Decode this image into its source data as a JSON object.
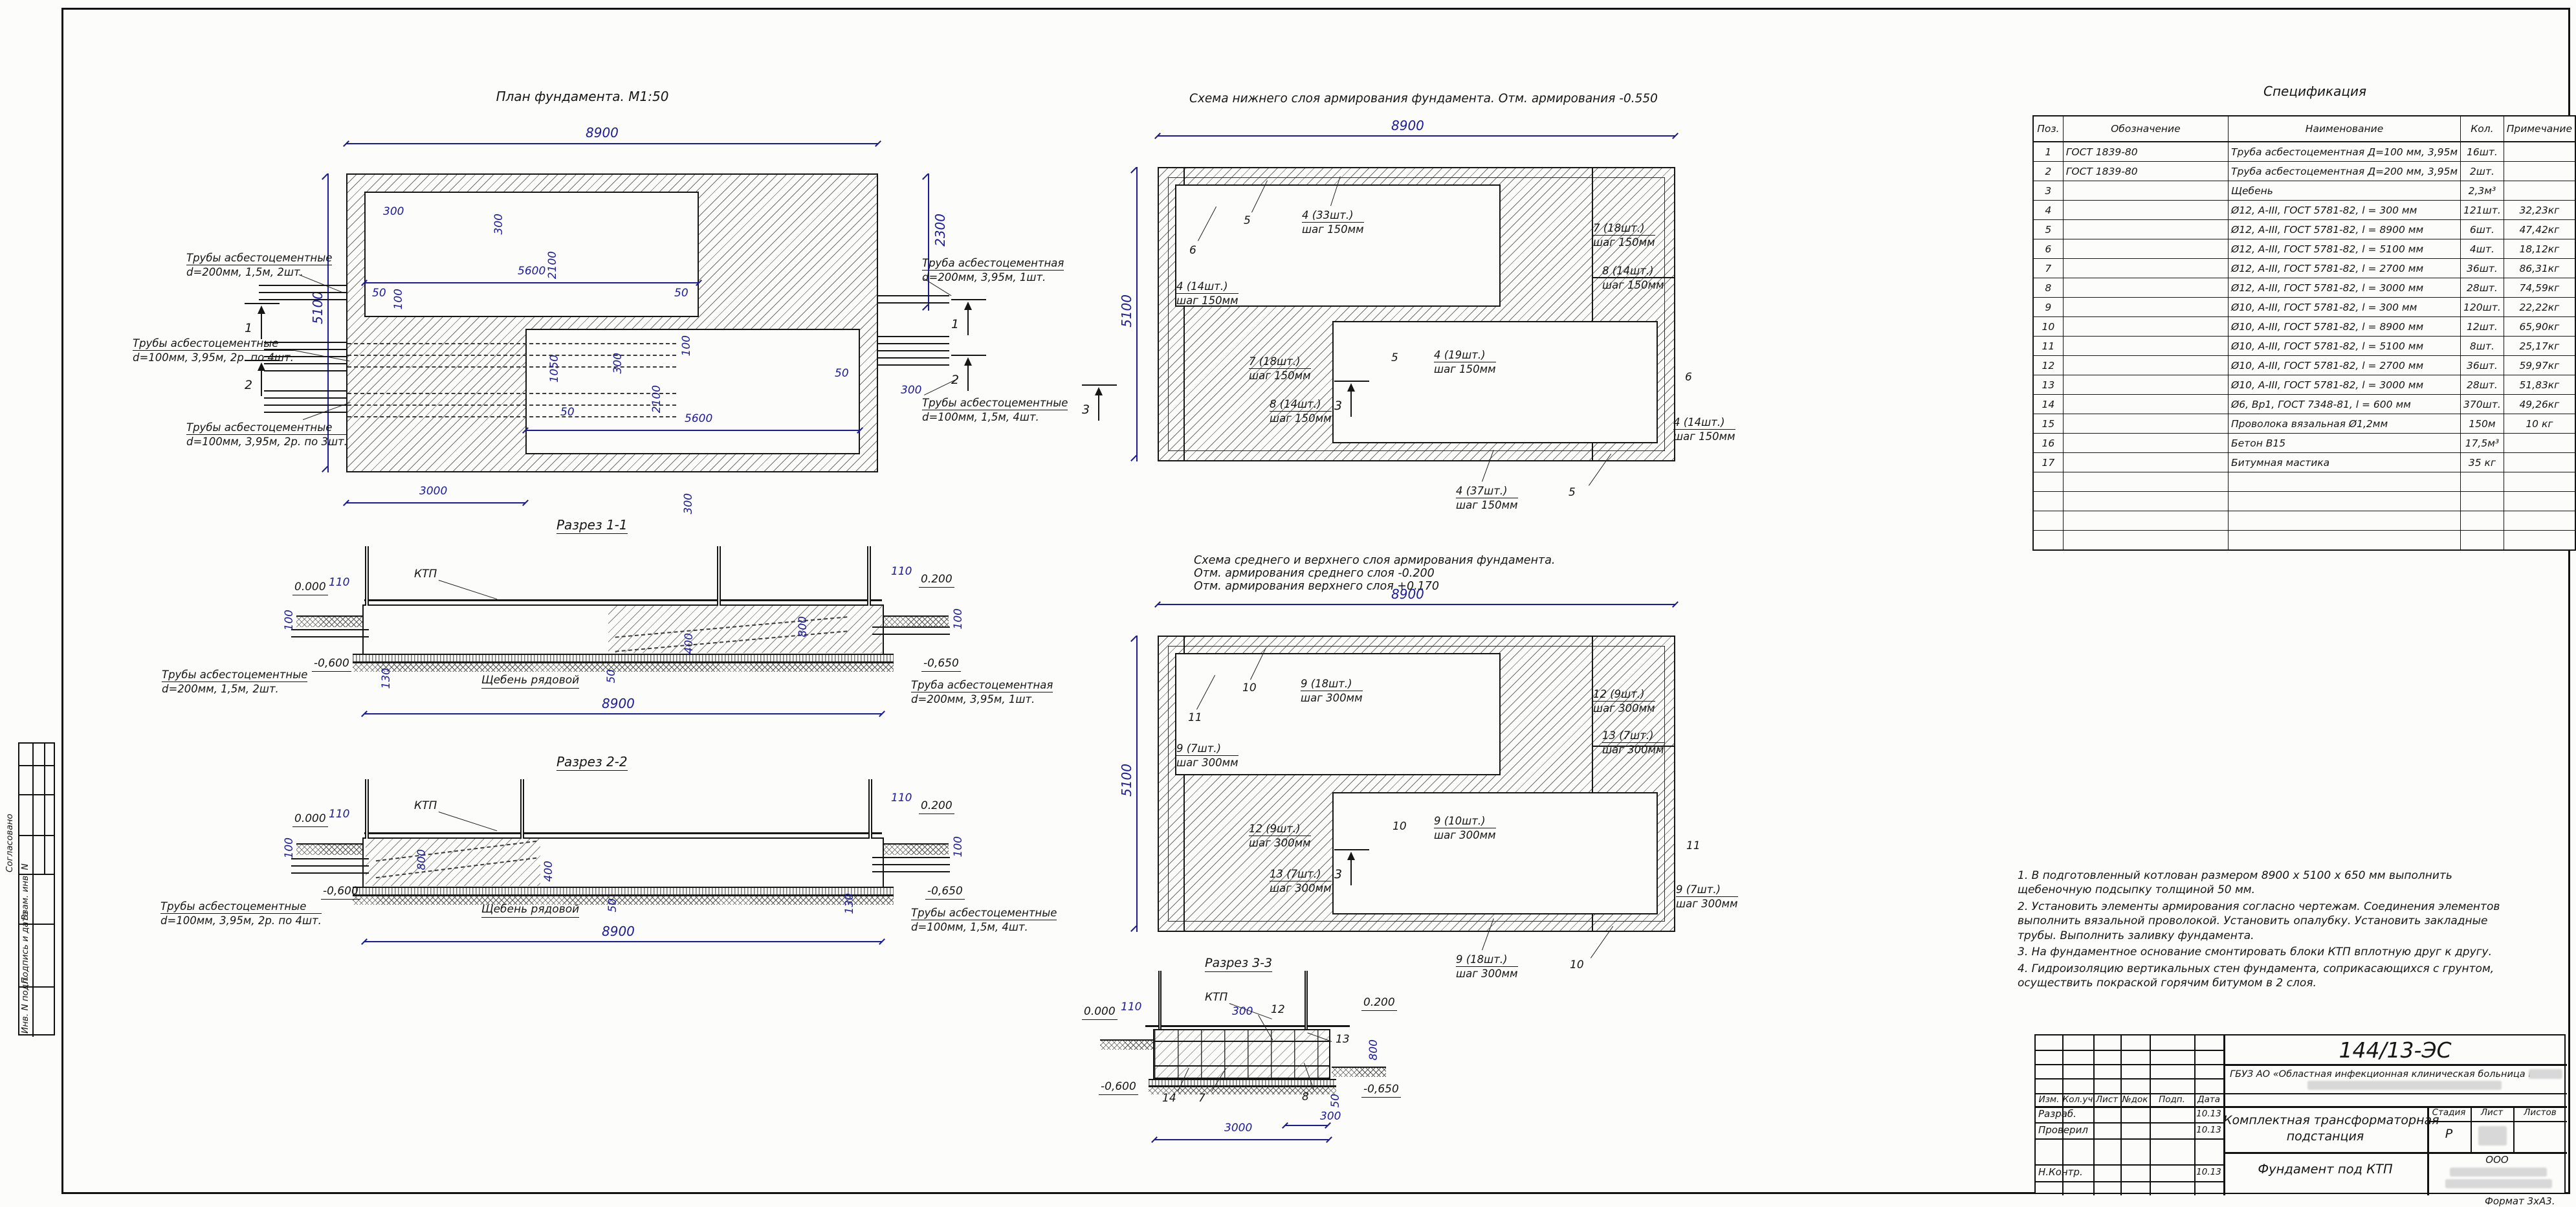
{
  "marks": {
    "m1": "1",
    "m2": "2",
    "m3": "3"
  },
  "side_stamp": {
    "soglasovano": "Согласовано",
    "vzam": "Взам. инв. N",
    "podpis": "Подпись и дата",
    "inv": "Инв. N подл."
  },
  "format_note": "Формат 3xА3.",
  "plan": {
    "title": "План фундамента. М1:50",
    "dims": {
      "d8900": "8900",
      "d5100": "5100",
      "d2300": "2300",
      "d300": "300",
      "d2100": "2100",
      "d5600": "5600",
      "d50": "50",
      "d100": "100",
      "d1050": "1050",
      "d3000": "3000"
    },
    "pipes": {
      "left_top": [
        "Трубы асбестоцементные",
        "d=200мм, 1,5м, 2шт."
      ],
      "left_mid": [
        "Трубы асбестоцементные",
        "d=100мм, 3,95м, 2р. по 4шт."
      ],
      "left_bot": [
        "Трубы асбестоцементные",
        "d=100мм, 3,95м, 2р. по 3шт."
      ],
      "right_top": [
        "Труба асбестоцементная",
        "d=200мм, 3,95м, 1шт."
      ],
      "right_bot": [
        "Трубы асбестоцементные",
        "d=100мм, 1,5м, 4шт."
      ]
    }
  },
  "scheme1": {
    "title": "Схема нижнего слоя армирования фундамента. Отм. армирования -0.550",
    "dims": {
      "d8900": "8900",
      "d5100": "5100"
    },
    "callouts": {
      "c5": "5",
      "c6": "6",
      "a33": [
        "4 (33шт.)",
        "шаг 150мм"
      ],
      "a14": [
        "4 (14шт.)",
        "шаг 150мм"
      ],
      "a19": [
        "4 (19шт.)",
        "шаг 150мм"
      ],
      "a37": [
        "4 (37шт.)",
        "шаг 150мм"
      ],
      "b18": [
        "7 (18шт.)",
        "шаг 150мм"
      ],
      "b14": [
        "8 (14шт.)",
        "шаг 150мм"
      ]
    }
  },
  "scheme2": {
    "title_line1": "Схема среднего и верхнего слоя армирования фундамента.",
    "title_line2": "Отм. армирования среднего слоя -0.200",
    "title_line3": "Отм. армирования верхнего слоя +0.170",
    "dims": {
      "d8900": "8900",
      "d5100": "5100"
    },
    "callouts": {
      "c10": "10",
      "c11": "11",
      "n18": [
        "9 (18шт.)",
        "шаг 300мм"
      ],
      "n7": [
        "9 (7шт.)",
        "шаг 300мм"
      ],
      "n10": [
        "9 (10шт.)",
        "шаг 300мм"
      ],
      "m9": [
        "12 (9шт.)",
        "шаг 300мм"
      ],
      "m7": [
        "13 (7шт.)",
        "шаг 300мм"
      ]
    }
  },
  "sections": {
    "s1_title": "Разрез 1-1",
    "s2_title": "Разрез 2-2",
    "s3_title": "Разрез 3-3",
    "ktp": "КТП",
    "gravel": "Щебень рядовой",
    "levels": {
      "zero": "0.000",
      "plus200": "0.200",
      "minus600": "-0,600",
      "minus650": "-0,650"
    },
    "dims": {
      "d110": "110",
      "d100": "100",
      "d800": "800",
      "d400": "400",
      "d50": "50",
      "d130": "130",
      "d8900": "8900",
      "d300": "300",
      "d3000": "3000"
    },
    "bars": {
      "r7": "7",
      "r8": "8",
      "r12": "12",
      "r13": "13",
      "r14": "14"
    },
    "s1_pipe_left": [
      "Трубы асбестоцементные",
      "d=200мм, 1,5м, 2шт."
    ],
    "s1_pipe_right": [
      "Труба асбестоцементная",
      "d=200мм, 3,95м, 1шт."
    ],
    "s2_pipe_left": [
      "Трубы асбестоцементные",
      "d=100мм, 3,95м, 2р. по 4шт."
    ],
    "s2_pipe_right": [
      "Трубы асбестоцементные",
      "d=100мм, 1,5м, 4шт."
    ]
  },
  "specification": {
    "title": "Спецификация",
    "headers": [
      "Поз.",
      "Обозначение",
      "Наименование",
      "Кол.",
      "Примечание"
    ],
    "rows": [
      [
        "1",
        "ГОСТ 1839-80",
        "Труба асбестоцементная Д=100 мм, 3,95м",
        "16шт.",
        ""
      ],
      [
        "2",
        "ГОСТ 1839-80",
        "Труба асбестоцементная Д=200 мм, 3,95м",
        "2шт.",
        ""
      ],
      [
        "3",
        "",
        "Щебень",
        "2,3м³",
        ""
      ],
      [
        "4",
        "",
        "Ø12, А-III, ГОСТ 5781-82, l = 300 мм",
        "121шт.",
        "32,23кг"
      ],
      [
        "5",
        "",
        "Ø12, А-III, ГОСТ 5781-82, l = 8900 мм",
        "6шт.",
        "47,42кг"
      ],
      [
        "6",
        "",
        "Ø12, А-III, ГОСТ 5781-82, l = 5100 мм",
        "4шт.",
        "18,12кг"
      ],
      [
        "7",
        "",
        "Ø12, А-III, ГОСТ 5781-82, l = 2700 мм",
        "36шт.",
        "86,31кг"
      ],
      [
        "8",
        "",
        "Ø12, А-III, ГОСТ 5781-82, l = 3000 мм",
        "28шт.",
        "74,59кг"
      ],
      [
        "9",
        "",
        "Ø10, А-III, ГОСТ 5781-82, l = 300 мм",
        "120шт.",
        "22,22кг"
      ],
      [
        "10",
        "",
        "Ø10, А-III, ГОСТ 5781-82, l = 8900 мм",
        "12шт.",
        "65,90кг"
      ],
      [
        "11",
        "",
        "Ø10, А-III, ГОСТ 5781-82, l = 5100 мм",
        "8шт.",
        "25,17кг"
      ],
      [
        "12",
        "",
        "Ø10, А-III, ГОСТ 5781-82, l = 2700 мм",
        "36шт.",
        "59,97кг"
      ],
      [
        "13",
        "",
        "Ø10, А-III, ГОСТ 5781-82, l = 3000 мм",
        "28шт.",
        "51,83кг"
      ],
      [
        "14",
        "",
        "Ø6, Вр1, ГОСТ 7348-81, l = 600 мм",
        "370шт.",
        "49,26кг"
      ],
      [
        "15",
        "",
        "Проволока вязальная Ø1,2мм",
        "150м",
        "10 кг"
      ],
      [
        "16",
        "",
        "Бетон В15",
        "17,5м³",
        ""
      ],
      [
        "17",
        "",
        "Битумная мастика",
        "35 кг",
        ""
      ],
      [
        "",
        "",
        "",
        "",
        ""
      ],
      [
        "",
        "",
        "",
        "",
        ""
      ],
      [
        "",
        "",
        "",
        "",
        ""
      ],
      [
        "",
        "",
        "",
        "",
        ""
      ]
    ]
  },
  "notes": [
    "1.  В подготовленный котлован размером  8900 х 5100 х 650 мм  выполнить  щебеночную  подсыпку толщиной  50 мм.",
    "2.  Установить элементы армирования согласно чертежам. Соединения элементов выполнить вязальной проволокой. Установить опалубку. Установить закладные трубы. Выполнить заливку фундамента.",
    "3.  На  фундаментное  основание смонтировать  блоки КТП  вплотную  друг  к  другу.",
    "4.  Гидроизоляцию  вертикальных  стен  фундамента,  соприкасающихся  с грунтом,  осуществить  покраской  горячим  битумом  в  2  слоя."
  ],
  "title_block": {
    "doc_number": "144/13-ЭС",
    "client": "ГБУЗ АО «Областная инфекционная клиническая больница им.",
    "rev_headers": [
      "Изм.",
      "Кол.уч",
      "Лист",
      "№док",
      "Подп.",
      "Дата"
    ],
    "roles": [
      {
        "label": "Разраб.",
        "date": "10.13"
      },
      {
        "label": "Проверил",
        "date": "10.13"
      },
      {
        "label": "Н.Контр.",
        "date": "10.13"
      }
    ],
    "project": "Комплектная трансформаторная",
    "project2": "подстанция",
    "sheet_name": "Фундамент под КТП",
    "stage_headers": [
      "Стадия",
      "Лист",
      "Листов"
    ],
    "stage": "Р",
    "company": "ООО"
  }
}
